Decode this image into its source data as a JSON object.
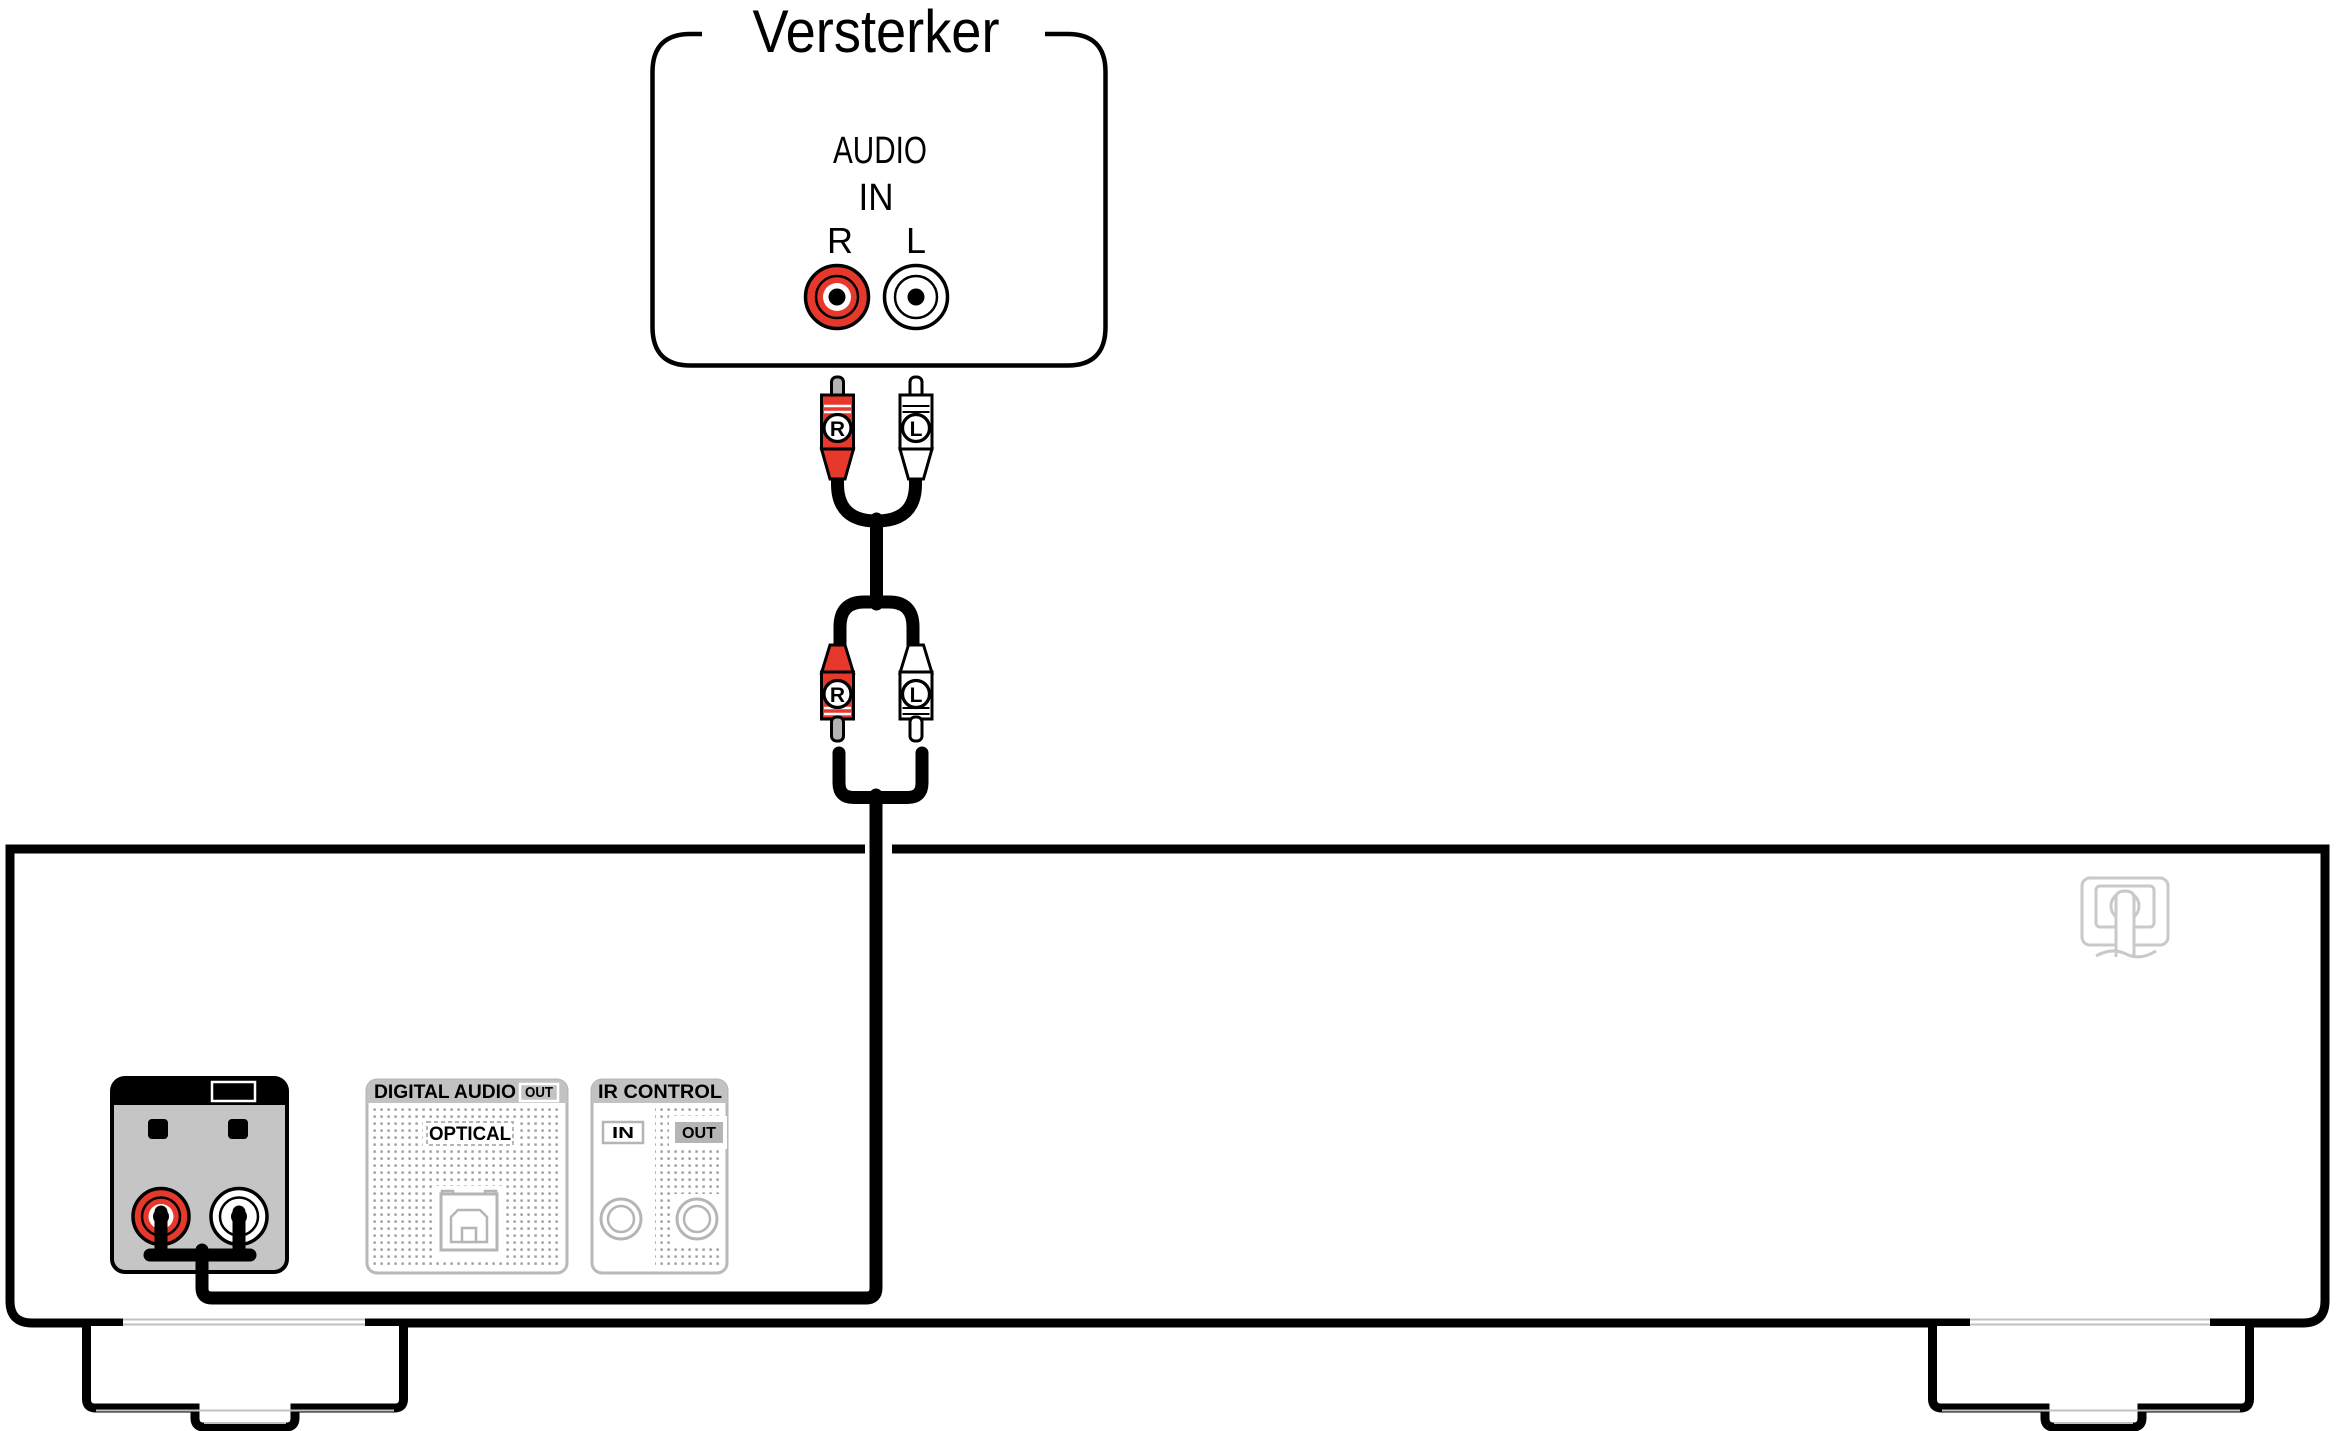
{
  "title": "Versterker",
  "amplifier": {
    "label": "Versterker",
    "jack_group_line1": "AUDIO",
    "jack_group_line2": "IN",
    "right_label": "R",
    "left_label": "L"
  },
  "cable": {
    "top_plug_right_letter": "R",
    "top_plug_left_letter": "L",
    "bottom_plug_right_letter": "R",
    "bottom_plug_left_letter": "L"
  },
  "device": {
    "audio_out_panel": {
      "title": "AUDIO",
      "badge": "OUT",
      "right_label": "R",
      "left_label": "L"
    },
    "digital_audio_panel": {
      "title": "DIGITAL AUDIO",
      "badge": "OUT",
      "connector_label": "OPTICAL"
    },
    "ir_control_panel": {
      "title": "IR CONTROL",
      "in_label": "IN",
      "out_label": "OUT"
    }
  },
  "colors": {
    "red": "#e6392c",
    "jack_white": "#ffffff",
    "panel_gray": "#c5c5c5",
    "inactive_band_gray": "#c2c2c2",
    "inactive_stroke_gray": "#b5b5b5",
    "panel_border_gray": "#b9b9b9",
    "dot_gray": "#9b9b9b",
    "pin_gray": "#b3b3b3",
    "logo_gray": "#c9c9c9",
    "line_black": "#000000"
  }
}
